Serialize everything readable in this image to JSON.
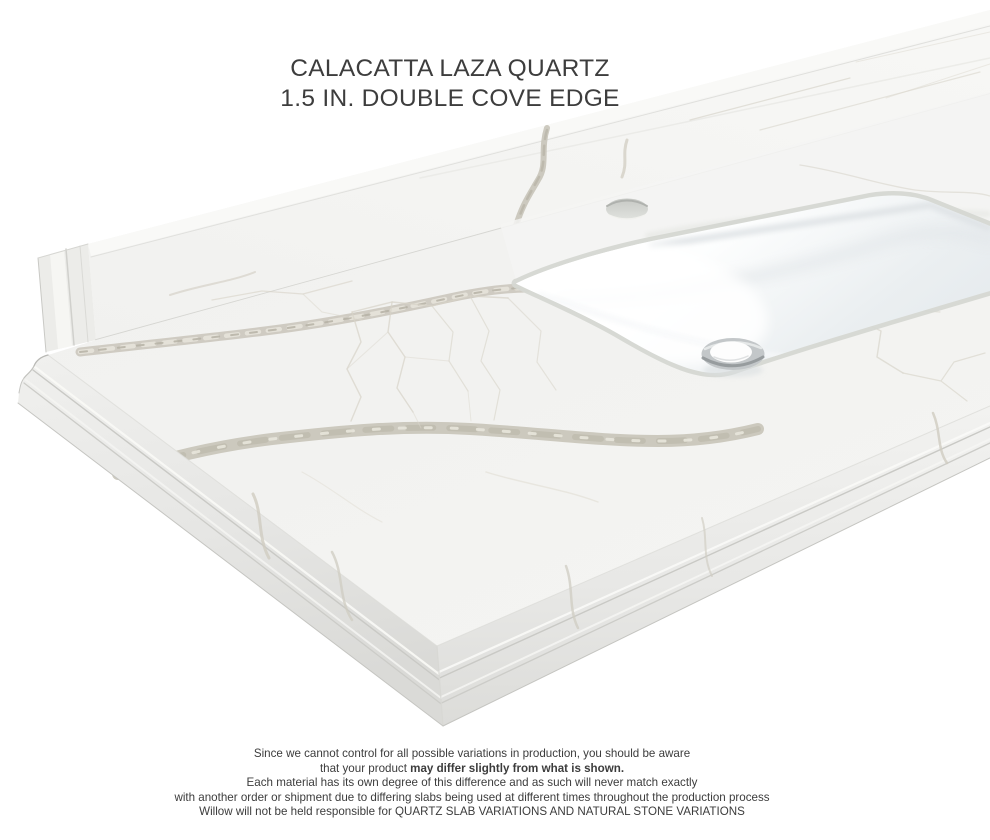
{
  "page": {
    "background": "#ffffff"
  },
  "title": {
    "line1": "CALACATTA LAZA QUARTZ",
    "line2": "1.5 IN. DOUBLE COVE EDGE",
    "color": "#3d3d3d"
  },
  "disclaimer": {
    "line1": "Since we cannot control for all possible variations in production, you should be aware",
    "line2_normal": "that your product ",
    "line2_bold": "may differ slightly from what is shown.",
    "line3": "Each material has its own degree of this difference and as such will never match exactly",
    "line4": "with another order or shipment due to differing slabs being used at different times throughout the production process",
    "line5": "Willow will not be held responsible for QUARTZ SLAB VARIATIONS AND NATURAL STONE VARIATIONS",
    "color": "#3c3c3c"
  },
  "illustration": {
    "subject": "Quartz vanity countertop with backsplash, undermount rectangular sink, single faucet hole and chrome drain",
    "colors": {
      "quartz_surface": "#f2f2f0",
      "marble_vein": "#c6c2b7",
      "edge_shadow": "#dcdcd9",
      "sink_white": "#ffffff",
      "basin_shadow": "#e8ecef",
      "drain_chrome": "#b9bdbf",
      "faucet_hole": "#cfd1cd"
    }
  }
}
